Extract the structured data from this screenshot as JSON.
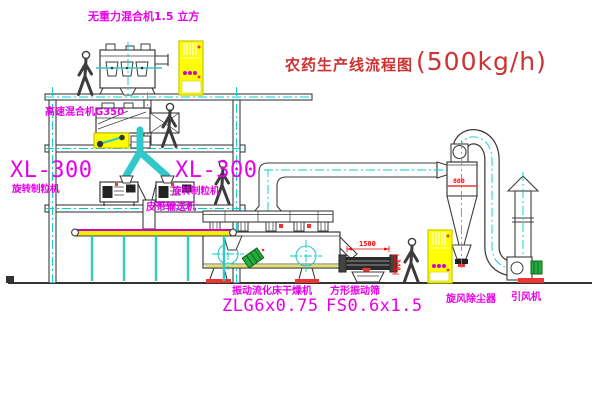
{
  "title": {
    "text": "农药生产线流程图",
    "capacity": "(500kg/h)"
  },
  "equipment": {
    "gravityless_mixer": {
      "label": "无重力混合机1.5 立方"
    },
    "high_speed_mixer": {
      "label": "高速混合机G350"
    },
    "granulator_left": {
      "model": "XL-300",
      "name": "旋转制粒机"
    },
    "granulator_center": {
      "model": "XL-300",
      "name": "旋转制粒机"
    },
    "belt_conveyor": {
      "label": "皮带输送机"
    },
    "fluid_bed_dryer": {
      "name": "振动流化床干燥机",
      "model": "ZLG6x0.75"
    },
    "vibrating_sieve": {
      "name": "方形振动筛",
      "model": "FS0.6x1.5"
    },
    "cyclone": {
      "label": "旋风除尘器"
    },
    "induced_draft_fan": {
      "label": "引风机"
    }
  },
  "dimensions": {
    "sieve_length": "1500",
    "cyclone_marking": "800",
    "sieve_height": "340"
  },
  "colors": {
    "label_magenta": "#e800e8",
    "title_red": "#cc3333",
    "dimension_red": "#ff0000",
    "centerline_cyan": "#00cccc",
    "cabinet_yellow": "#ffff00",
    "motor_green": "#22aa44",
    "line_dark": "#3c3c3c"
  }
}
